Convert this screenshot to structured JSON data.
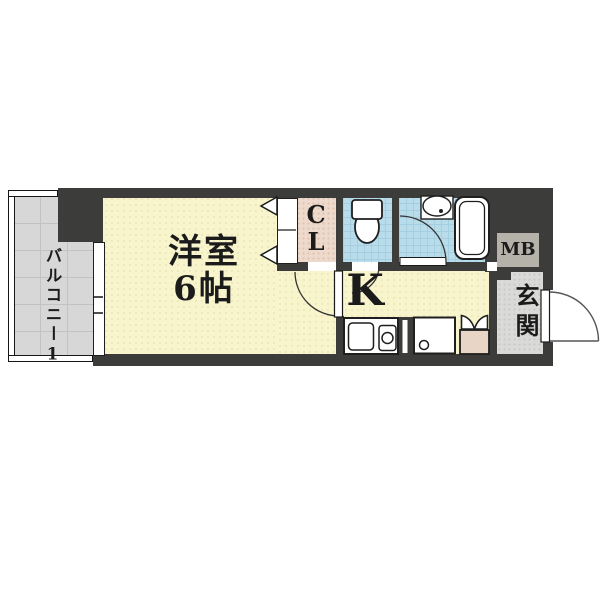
{
  "floorplan": {
    "type": "apartment-floor-plan",
    "rooms": {
      "balcony": {
        "label": "バルコニー1"
      },
      "western_room": {
        "label": "洋室",
        "size": "6帖"
      },
      "closet": {
        "line1": "C",
        "line2": "L"
      },
      "kitchen": {
        "label": "K"
      },
      "meter_box": {
        "label": "MB"
      },
      "entrance": {
        "label": "玄関"
      }
    },
    "colors": {
      "wall": "#3c3c3a",
      "room_floor": "#f8f4cc",
      "wet_area": "#b9dcea",
      "balcony": "#d7d7d7",
      "closet": "#eedacd",
      "entrance": "#dadad8",
      "meter_box": "#b5b2a9",
      "shoe_cabinet": "#e9d5c5",
      "outline": "#1f1f1f"
    }
  }
}
